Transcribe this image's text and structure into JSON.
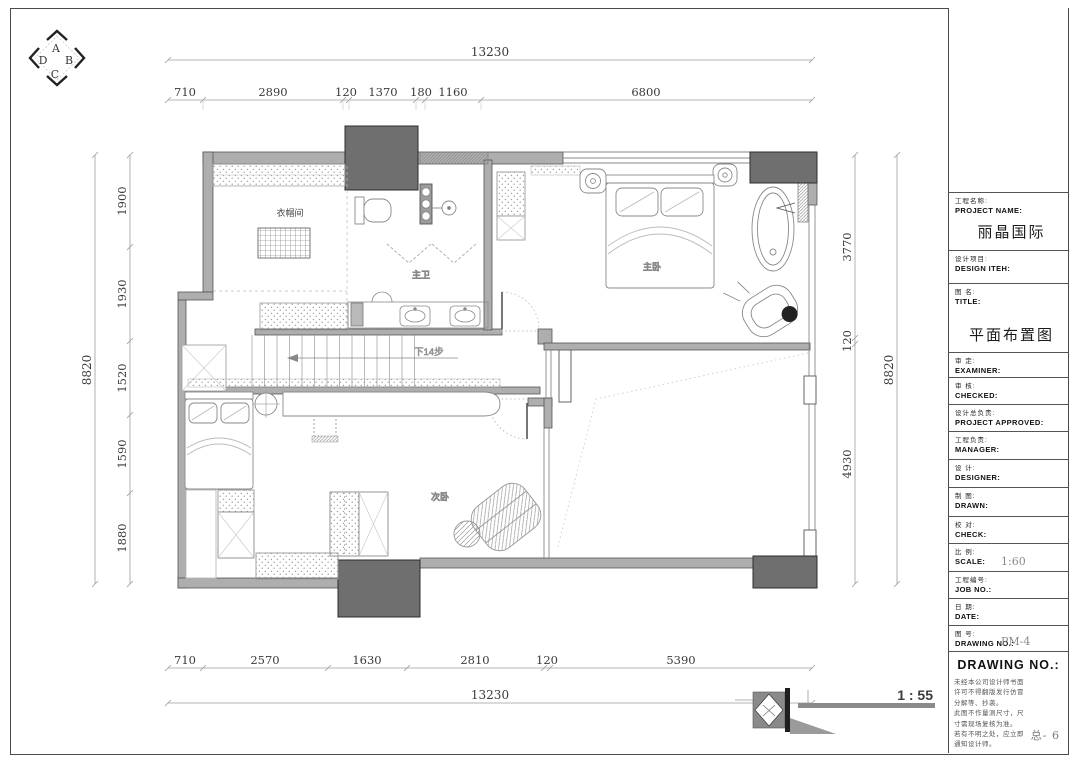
{
  "compass": {
    "top": "A",
    "right": "B",
    "bottom": "C",
    "left": "D"
  },
  "dimensions": {
    "top_total": "13230",
    "top_segments": [
      "710",
      "2890",
      "120",
      "1370",
      "180",
      "1160",
      "6800"
    ],
    "bottom_segments": [
      "710",
      "2570",
      "1630",
      "2810",
      "120",
      "5390"
    ],
    "bottom_total": "13230",
    "left_total": "8820",
    "left_segments": [
      "1900",
      "1930",
      "1520",
      "1590",
      "1880"
    ],
    "right_segments": [
      "3770",
      "120",
      "4930"
    ],
    "right_total": "8820"
  },
  "rooms": {
    "cloakroom": "衣帽间",
    "master_bath": "主卫",
    "master_bedroom": "主卧",
    "second_bedroom": "次卧",
    "stairs_note": "下14步"
  },
  "scale_bar_label": "1 : 55",
  "title_block": {
    "fields": [
      {
        "cn": "工程名称:",
        "en": "PROJECT NAME:",
        "value": "丽晶国际"
      },
      {
        "cn": "设计项目:",
        "en": "DESIGN ITEH:",
        "value": ""
      },
      {
        "cn": "图  名:",
        "en": "TITLE:",
        "value": "平面布置图"
      },
      {
        "cn": "审  定:",
        "en": "EXAMINER:",
        "value": ""
      },
      {
        "cn": "审  核:",
        "en": "CHECKED:",
        "value": ""
      },
      {
        "cn": "设计总负责:",
        "en": "PROJECT APPROVED:",
        "value": ""
      },
      {
        "cn": "工程负责:",
        "en": "MANAGER:",
        "value": ""
      },
      {
        "cn": "设  计:",
        "en": "DESIGNER:",
        "value": ""
      },
      {
        "cn": "制  图:",
        "en": "DRAWN:",
        "value": ""
      },
      {
        "cn": "校  对:",
        "en": "CHECK:",
        "value": ""
      },
      {
        "cn": "比  例:",
        "en": "SCALE:",
        "value": "1:60"
      },
      {
        "cn": "工程编号:",
        "en": "JOB NO.:",
        "value": ""
      },
      {
        "cn": "日  期:",
        "en": "DATE:",
        "value": ""
      },
      {
        "cn": "图  号:",
        "en": "DRAWING NO.:",
        "value": "PM-4"
      }
    ],
    "drawing_no_header": "DRAWING NO.:",
    "notes": [
      "未经本公司设计师书面",
      "许可不得翻版发行仿冒",
      "分解等、抄袭。",
      "此图不作量测尺寸，尺",
      "寸需现场复核为准。",
      "若有不明之处，应立即",
      "通知设计师。"
    ],
    "sheet_no": "总- 6"
  }
}
